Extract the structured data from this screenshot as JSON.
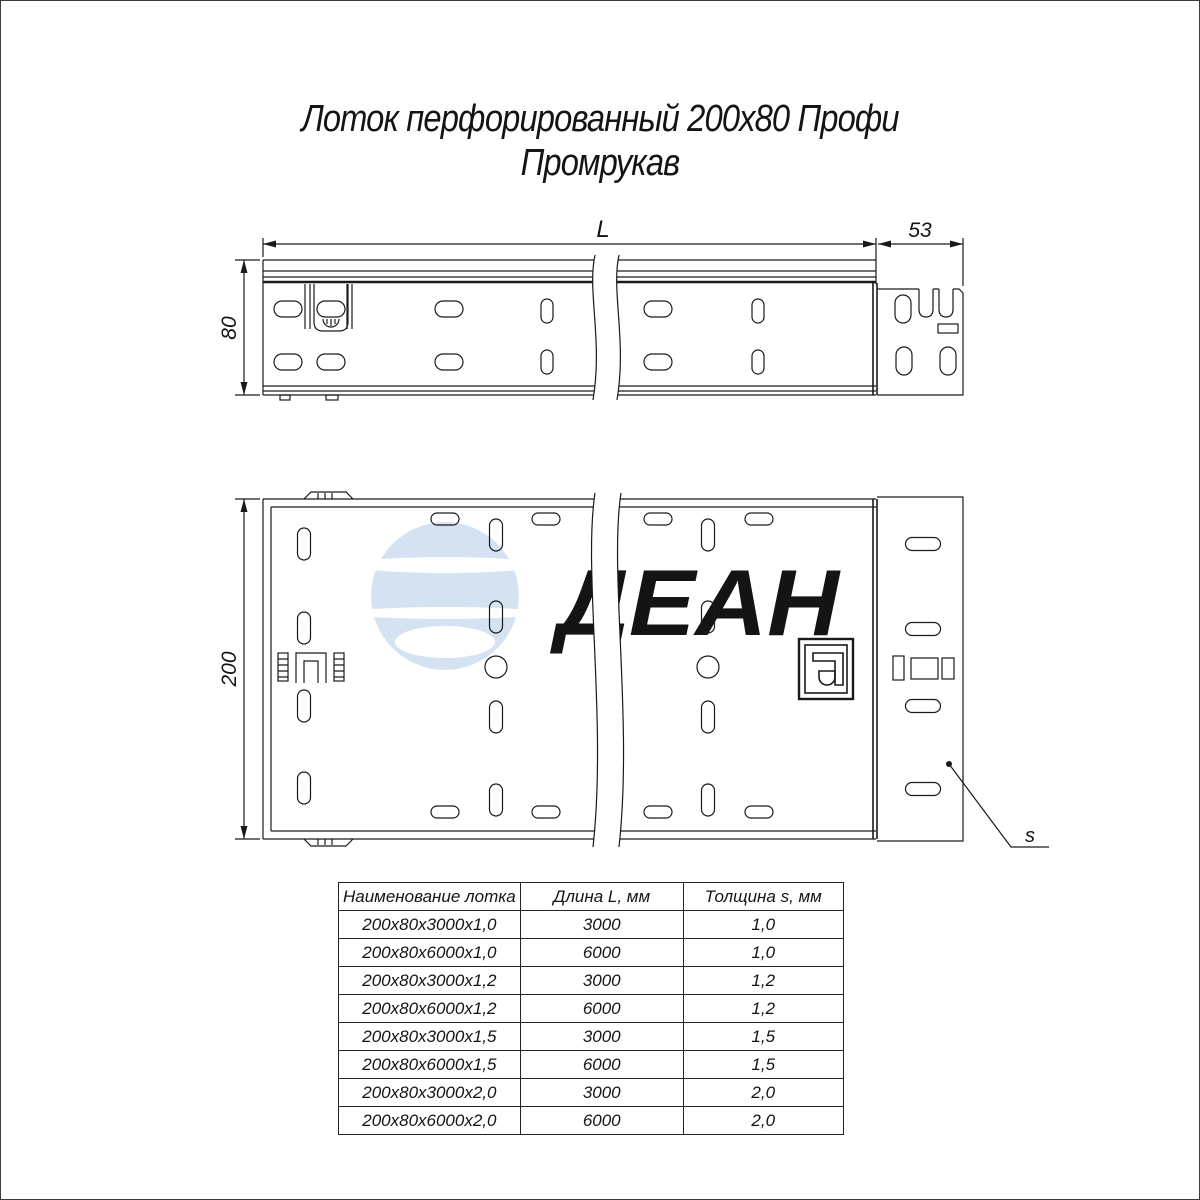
{
  "title": {
    "line1": "Лоток перфорированный 200х80 Профи",
    "line2": "Промрукав"
  },
  "watermark": {
    "text": "ДЕАН",
    "color": "#d4e2f1"
  },
  "dimensions": {
    "length": "L",
    "connector_width": "53",
    "height": "80",
    "width": "200",
    "thickness": "s"
  },
  "colors": {
    "line": "#1a1a1a",
    "watermark": "#d4e2f1",
    "background": "#ffffff",
    "page_border": "#3c3c3c"
  },
  "table": {
    "headers": [
      "Наименование лотка",
      "Длина L, мм",
      "Толщина s, мм"
    ],
    "rows": [
      [
        "200х80х3000х1,0",
        "3000",
        "1,0"
      ],
      [
        "200х80х6000х1,0",
        "6000",
        "1,0"
      ],
      [
        "200х80х3000х1,2",
        "3000",
        "1,2"
      ],
      [
        "200х80х6000х1,2",
        "6000",
        "1,2"
      ],
      [
        "200х80х3000х1,5",
        "3000",
        "1,5"
      ],
      [
        "200х80х6000х1,5",
        "6000",
        "1,5"
      ],
      [
        "200х80х3000х2,0",
        "3000",
        "2,0"
      ],
      [
        "200х80х6000х2,0",
        "6000",
        "2,0"
      ]
    ]
  }
}
